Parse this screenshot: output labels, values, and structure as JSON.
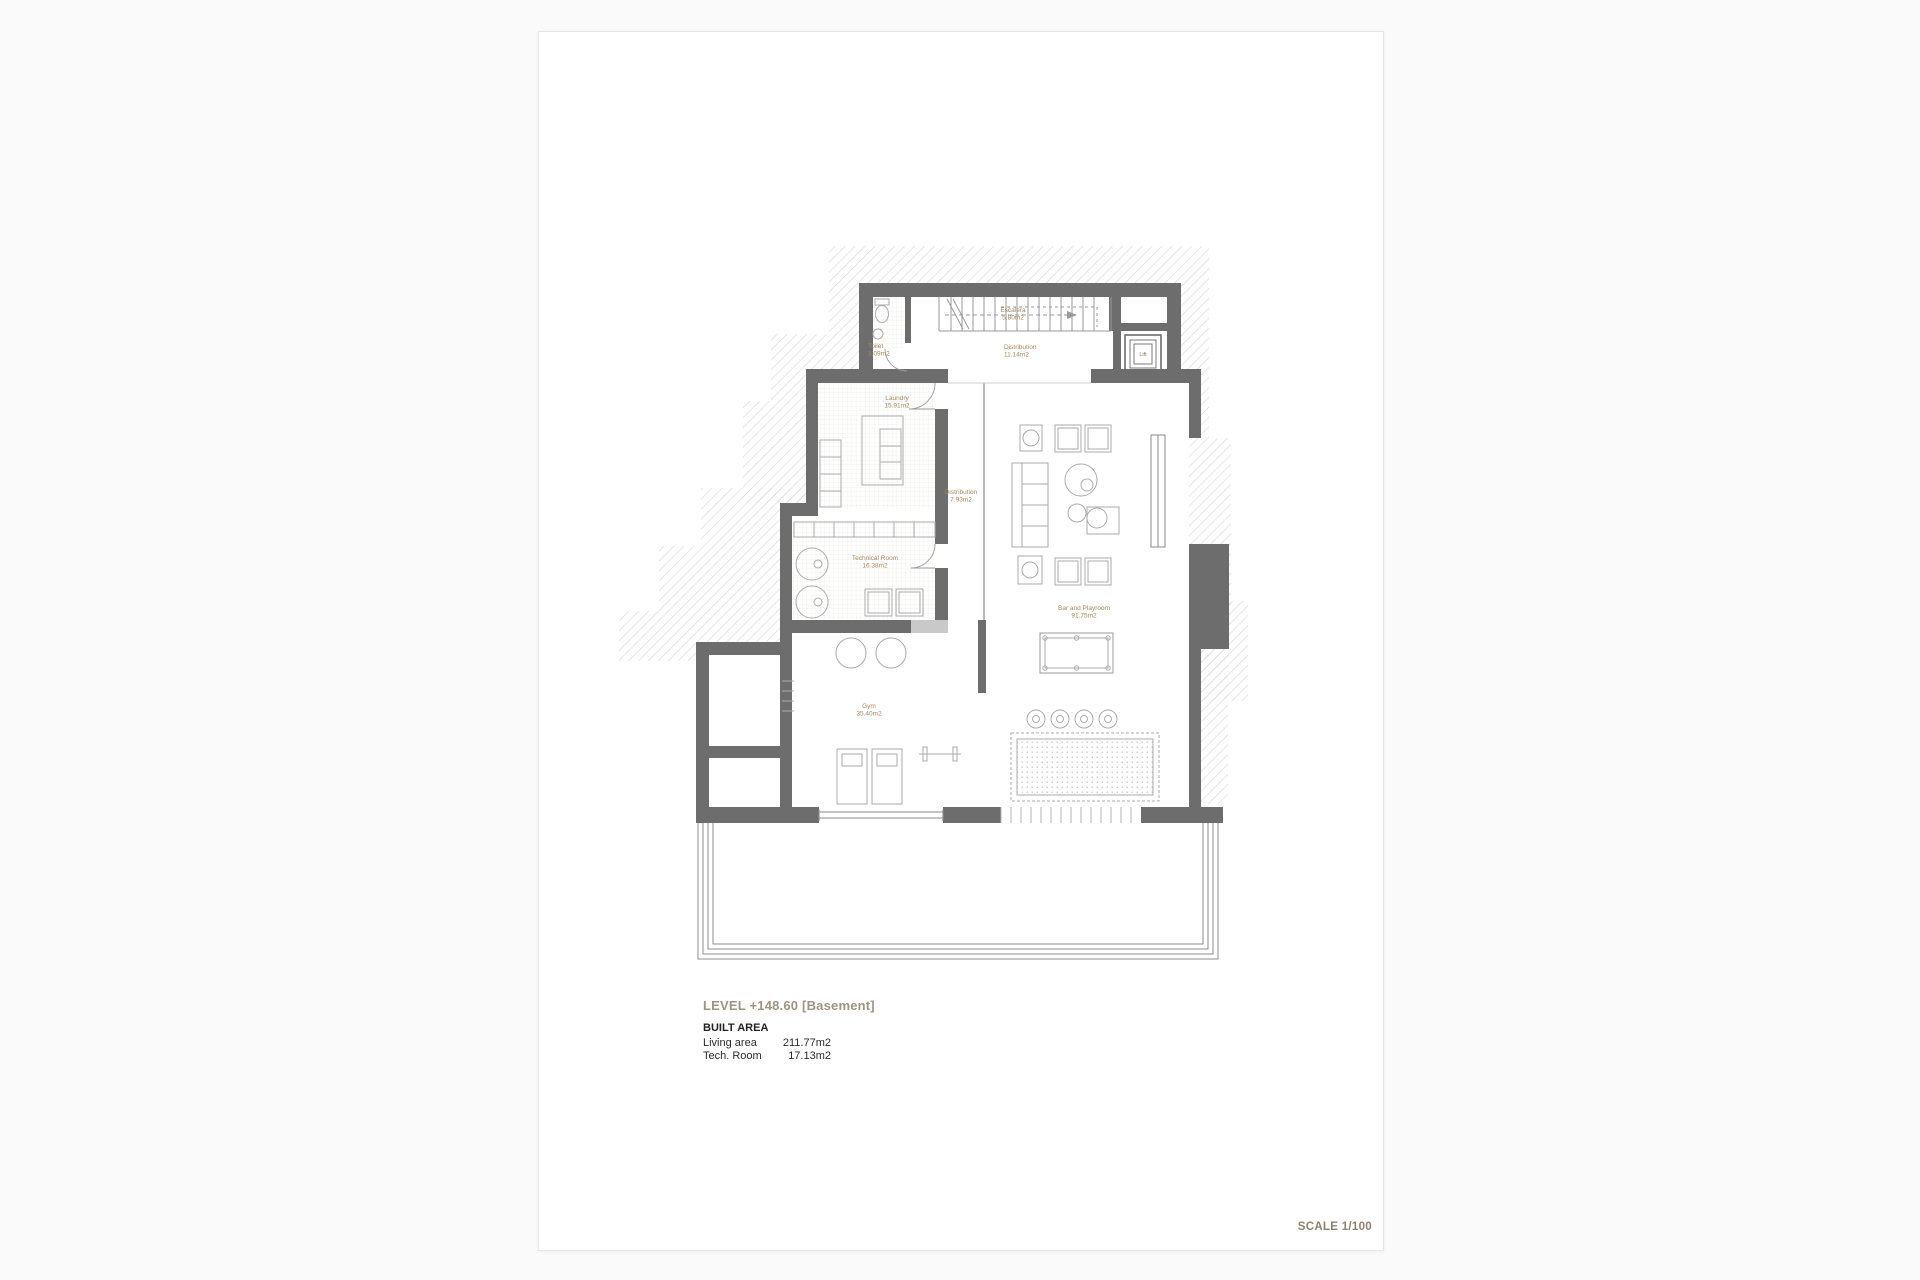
{
  "page": {
    "title_block": {
      "level_title": "LEVEL +148.60 [Basement]",
      "built_area_heading": "BUILT AREA",
      "areas": [
        {
          "label": "Living area",
          "value": "211.77m2"
        },
        {
          "label": "Tech. Room",
          "value": "17.13m2"
        }
      ]
    },
    "scale_label": "SCALE 1/100"
  },
  "plan": {
    "rooms": {
      "staircase": {
        "name": "Escalera",
        "area": "5.80m2"
      },
      "toilet": {
        "name": "Toilet",
        "area": "3.09m2"
      },
      "distribution_hall": {
        "name": "Distribution",
        "area": "11.14m2"
      },
      "lift": {
        "name": "Lift"
      },
      "laundry": {
        "name": "Laundry",
        "area": "15.91m2"
      },
      "distribution_corridor": {
        "name": "Distribution",
        "area": "7.93m2"
      },
      "technical_room": {
        "name": "Technical Room",
        "area": "16.38m2"
      },
      "bar_playroom": {
        "name": "Bar and Playroom",
        "area": "91.75m2"
      },
      "gym": {
        "name": "Gym",
        "area": "35.40m2"
      }
    }
  },
  "colors": {
    "wall": "#6d6d6d",
    "hatch_line": "#d9d9d9",
    "room_label": "#a6875f",
    "title_text": "#a09384",
    "scale_text": "#8e8170"
  }
}
